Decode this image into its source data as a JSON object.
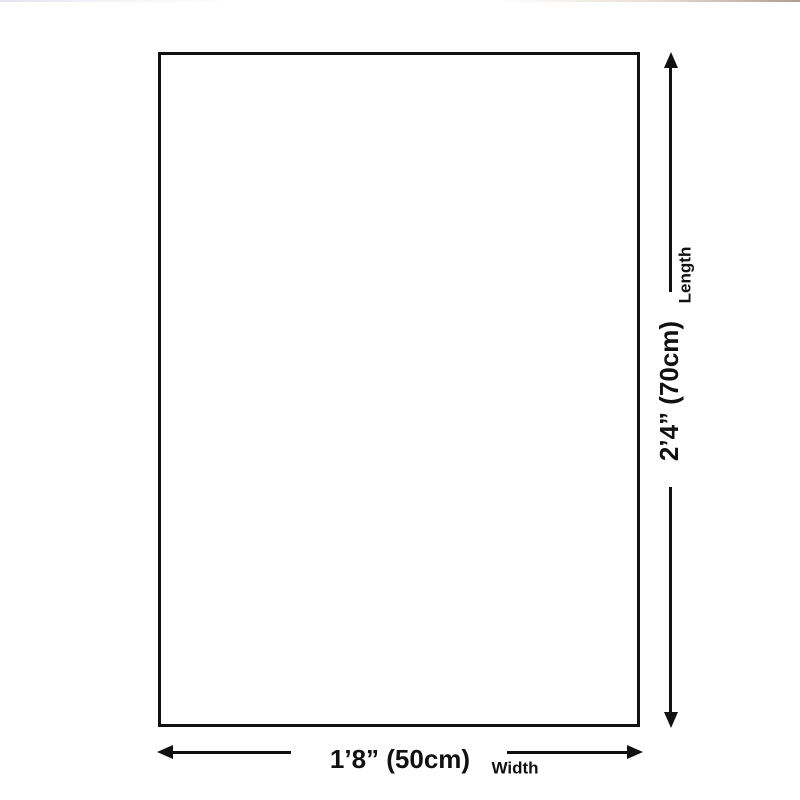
{
  "diagram": {
    "kind": "product-size-diagram",
    "colors": {
      "line": "#111111",
      "background": "#ffffff"
    },
    "width": {
      "value": "1’8” (50cm)",
      "label": "Width"
    },
    "length": {
      "value": "2’4” (70cm)",
      "label": "Length"
    },
    "icons": {
      "up": "arrow-up-icon",
      "down": "arrow-down-icon",
      "left": "arrow-left-icon",
      "right": "arrow-right-icon"
    }
  }
}
